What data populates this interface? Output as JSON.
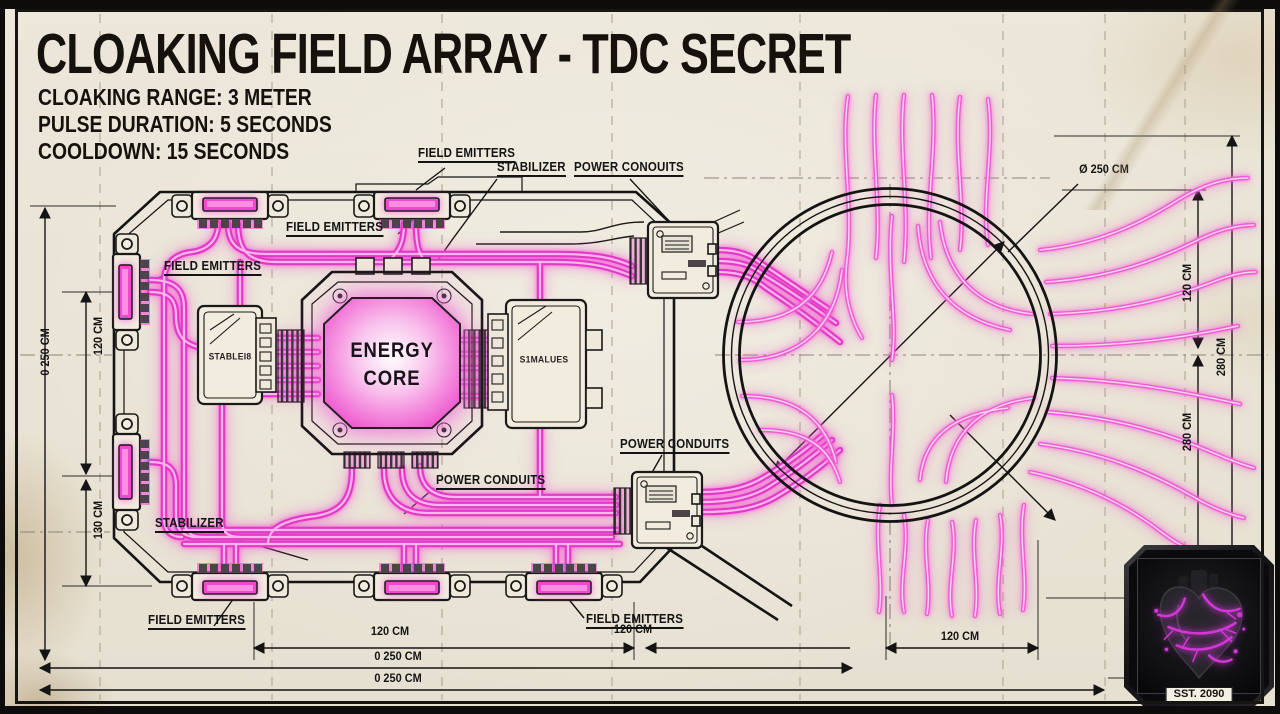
{
  "title": "CLOAKING FIELD ARRAY - TDC SECRET",
  "specs": {
    "range": "CLOAKING RANGE: 3 METER",
    "pulse": "PULSE DURATION: 5 SECONDS",
    "cooldown": "COOLDOWN: 15 SECONDS"
  },
  "labels": {
    "field_emitters_top": "FIELD EMITTERS",
    "stabilizer_top": "STABILIZER",
    "power_conduits_top": "POWER CONOUITS",
    "field_emitters_upper_mid": "FIELD EMITTERS",
    "field_emitters_left": "FIELD EMITTERS",
    "power_conduits_right": "POWER CONDUITS",
    "power_conduits_center": "POWER CONDUITS",
    "stabilizer_left": "STABILIZER",
    "field_emitters_bottom_left": "FIELD EMITTERS",
    "field_emitters_bottom_right": "FIELD EMITTERS"
  },
  "core": {
    "line1": "ENERGY",
    "line2": "CORE",
    "stabilizer_left_text": "STABLEI8",
    "stabilizer_right_text": "S1MALUES"
  },
  "dimensions": {
    "left_outer": "0 250 CM",
    "left_upper": "120 CM",
    "left_lower": "130 CM",
    "bottom_left_span": "120 CM",
    "bottom_right_span": "120 CM",
    "bottom_total_upper": "0 250 CM",
    "bottom_total_lower": "0 250 CM",
    "circle_diameter": "Ø 250 CM",
    "right_upper": "120 CM",
    "right_outer": "280 CM",
    "right_lower": "280 CM",
    "field_width": "120 CM"
  },
  "badge": {
    "caption": "SST. 2090"
  },
  "colors": {
    "conduit_magenta": "#e23ac7",
    "conduit_highlight": "#ffb6ec",
    "paper": "#ece7da",
    "ink": "#161616",
    "badge_vein": "#d438d8"
  }
}
